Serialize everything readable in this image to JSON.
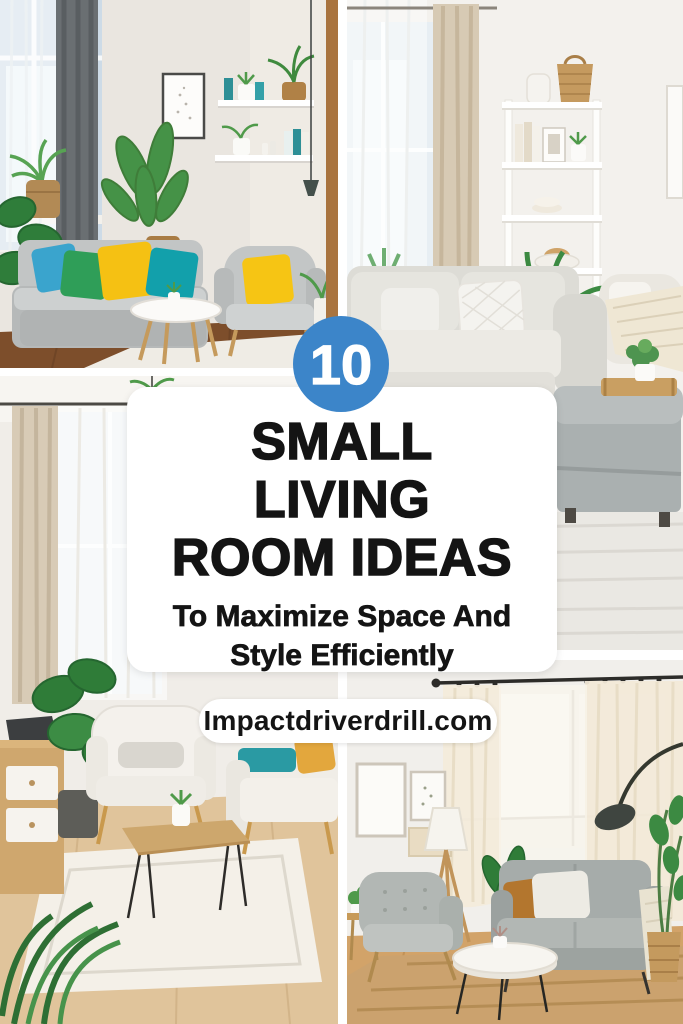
{
  "canvas": {
    "width": 683,
    "height": 1024,
    "gap_color": "#ffffff"
  },
  "badge": {
    "number": "10",
    "background": "#3c85c9",
    "color": "#ffffff"
  },
  "title_card": {
    "background": "#ffffff",
    "text_color": "#141414",
    "lines": [
      "SMALL",
      "LIVING",
      "ROOM IDEAS"
    ],
    "subtitle_lines": [
      "To Maximize Space And",
      "Style Efficiently"
    ]
  },
  "website_pill": {
    "label": "Impactdriverdrill.com",
    "background": "#ffffff",
    "text_color": "#141414"
  },
  "photos": [
    {
      "position": "top-left",
      "description": "Bright small living room with grey sofa, green teal yellow and blue throw pillows, potted plants, framed art, white wall shelves and a black pendant light"
    },
    {
      "position": "top-right",
      "description": "White living room corner with tall white shelving unit holding a woven basket, ceramic jar, books and plants, light grey sofa with white pillows, cream armchair with throw, and a grey storage ottoman topped with a wooden tray and small plant"
    },
    {
      "position": "bottom-left",
      "description": "Neutral living room with beige curtains, white armchair, light sofa with teal cushion and mustard pillow, wooden coffee table with hairpin legs, white rug, wooden media console and large houseplants"
    },
    {
      "position": "bottom-right",
      "description": "Cozy living room with grey tufted armchair, grey loveseat with white and caramel pillows and cream throw, round coffee table, tripod floor lamp, black arc lamp, gallery wall frames, sheer cream curtains and a jute rug"
    }
  ]
}
